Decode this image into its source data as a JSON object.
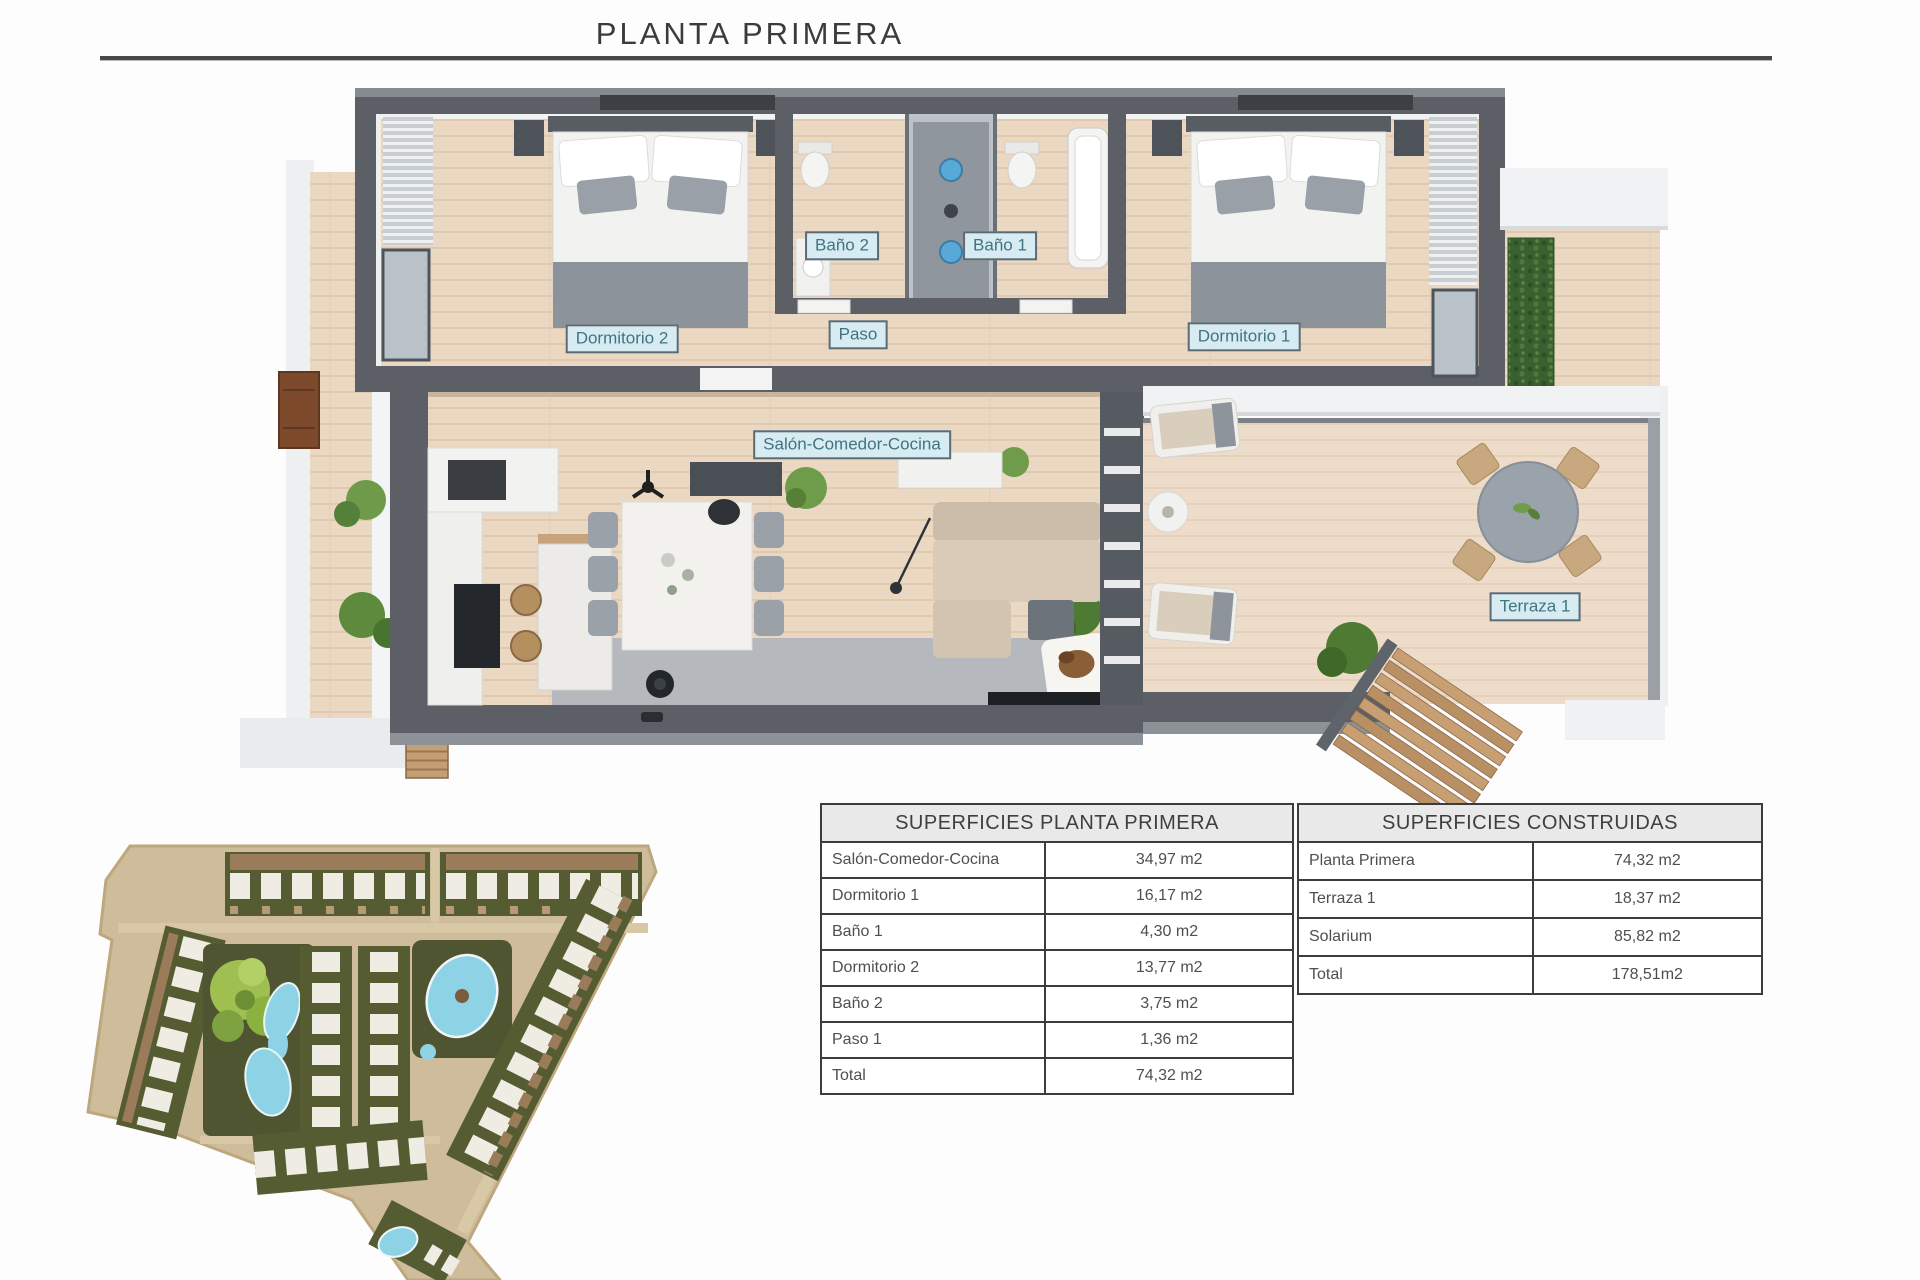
{
  "title": "PLANTA PRIMERA",
  "floor_plan": {
    "labels": {
      "dormitorio2": "Dormitorio 2",
      "dormitorio1": "Dormitorio 1",
      "bano2": "Baño 2",
      "bano1": "Baño 1",
      "paso": "Paso",
      "salon": "Salón-Comedor-Cocina",
      "terraza": "Terraza 1"
    }
  },
  "tables": {
    "planta_primera": {
      "title": "SUPERFICIES PLANTA PRIMERA",
      "rows": [
        {
          "label": "Salón-Comedor-Cocina",
          "value": "34,97 m2"
        },
        {
          "label": "Dormitorio 1",
          "value": "16,17 m2"
        },
        {
          "label": "Baño 1",
          "value": "4,30 m2"
        },
        {
          "label": "Dormitorio 2",
          "value": "13,77 m2"
        },
        {
          "label": "Baño 2",
          "value": "3,75 m2"
        },
        {
          "label": "Paso 1",
          "value": "1,36 m2"
        },
        {
          "label": "Total",
          "value": "74,32 m2"
        }
      ]
    },
    "construidas": {
      "title": "SUPERFICIES CONSTRUIDAS",
      "rows": [
        {
          "label": "Planta Primera",
          "value": "74,32 m2"
        },
        {
          "label": "Terraza 1",
          "value": "18,37 m2"
        },
        {
          "label": "Solarium",
          "value": "85,82 m2"
        },
        {
          "label": "Total",
          "value": "178,51m2"
        }
      ]
    }
  },
  "colors": {
    "label_bg": "#d7ebf2",
    "label_border": "#5d6a72",
    "label_text": "#417480",
    "wall": "#5c6066",
    "floor_wood": "#ebd8c3",
    "terrace_wood": "#eedccb",
    "pool_blue": "#8ed2e6",
    "park_green": "#9fc050",
    "site_base": "#cebc9a",
    "table_border": "#3c3c3c",
    "table_header_bg": "#e9e9e9"
  }
}
